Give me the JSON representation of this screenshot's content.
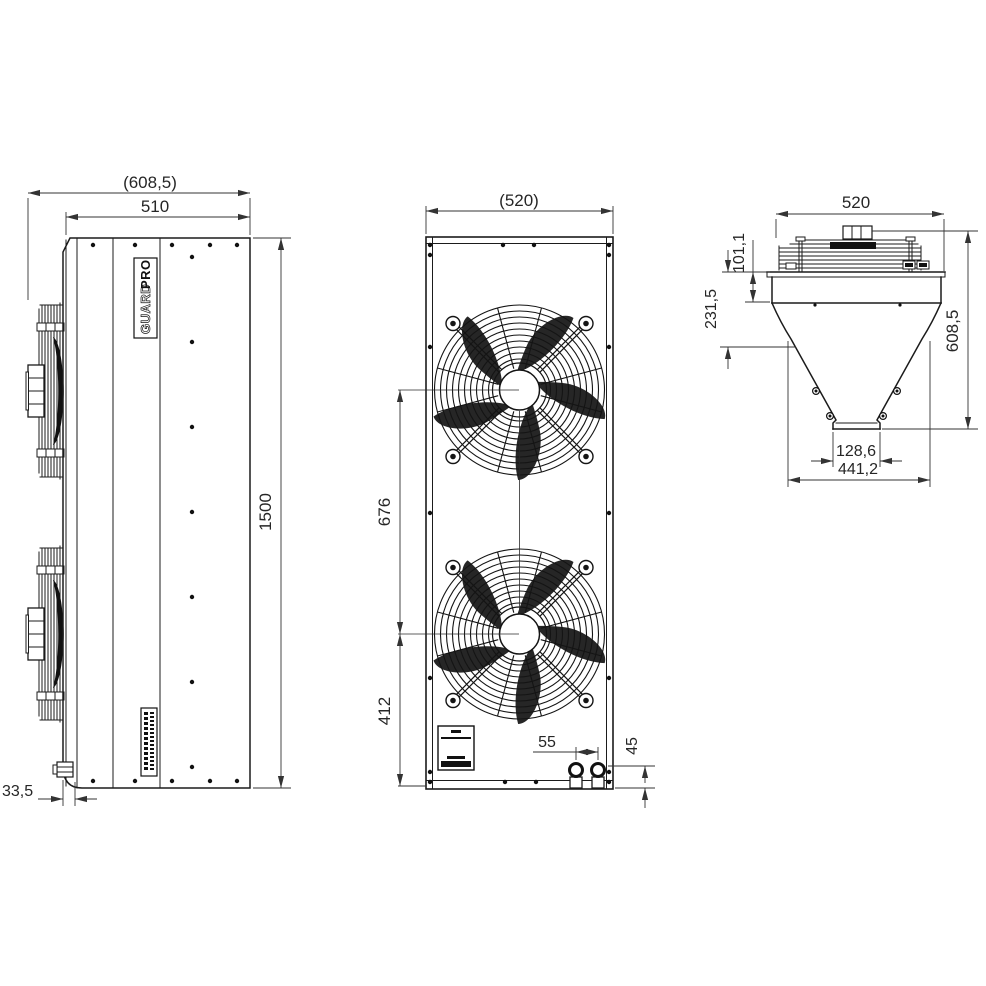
{
  "dims": {
    "side_overall_depth": "(608,5)",
    "side_body_depth": "510",
    "side_height": "1500",
    "side_drain_offset": "33,5",
    "front_width": "(520)",
    "front_fan_pitch": "676",
    "front_fan_to_bottom": "412",
    "front_pipe_spacing": "55",
    "front_pipe_offset": "45",
    "top_width": "520",
    "top_deck_height": "101,1",
    "top_coil_depth": "231,5",
    "top_total_height": "608,5",
    "top_outlet_width": "128,6",
    "top_funnel_width": "441,2"
  },
  "branding": {
    "logo_guard": "GUARD",
    "logo_pro": "PRO"
  },
  "line_color": "#1b1b1b",
  "background": "#ffffff"
}
